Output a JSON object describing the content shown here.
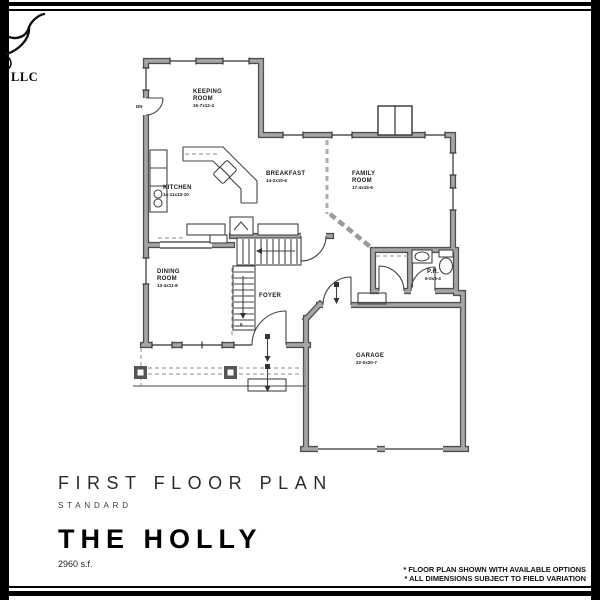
{
  "branding": {
    "company_suffix": "LLC"
  },
  "plan": {
    "rooms": {
      "keeping": {
        "line1": "KEEPING",
        "line2": "ROOM",
        "dims": "16-7x12-4"
      },
      "kitchen": {
        "line1": "KITCHEN",
        "dims": "14-11x13-10"
      },
      "breakfast": {
        "line1": "BREAKFAST",
        "dims": "14-2x10-6"
      },
      "family": {
        "line1": "FAMILY",
        "line2": "ROOM",
        "dims": "17-4x15-6"
      },
      "dining": {
        "line1": "DINING",
        "line2": "ROOM",
        "dims": "13-4x11-8"
      },
      "foyer": {
        "line1": "FOYER"
      },
      "powder": {
        "line1": "P.R.",
        "dims": "6-0x5-4"
      },
      "garage": {
        "line1": "GARAGE",
        "dims": "22-0x20-7"
      }
    },
    "markers": {
      "down": "DN",
      "stair_count": "5"
    }
  },
  "title_block": {
    "plan_title": "FIRST FLOOR PLAN",
    "option_label": "STANDARD",
    "model_name": "THE HOLLY",
    "area": "2960 s.f."
  },
  "notes": {
    "line1": "* FLOOR PLAN SHOWN WITH AVAILABLE OPTIONS",
    "line2": "* ALL DIMENSIONS SUBJECT TO FIELD VARIATION"
  },
  "colors": {
    "wall_fill": "#a6a6a6",
    "wall_edge": "#4f4f4f",
    "line": "#333333",
    "border": "#000000"
  }
}
